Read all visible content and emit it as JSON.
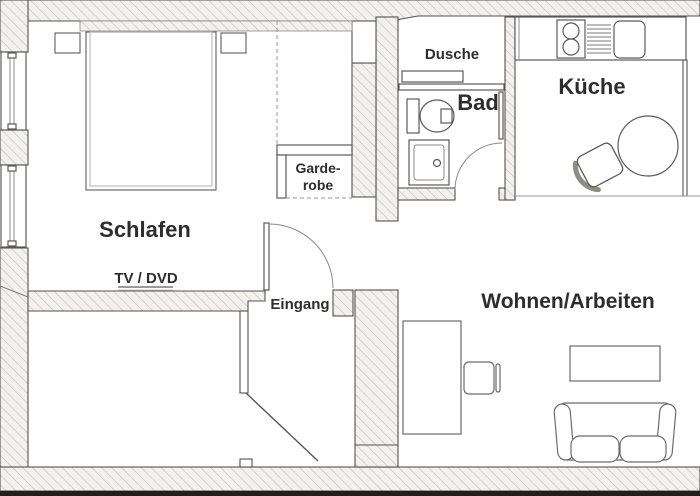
{
  "plan": {
    "type": "apartment-floorplan",
    "labels": {
      "schlafen": "Schlafen",
      "tv_dvd": "TV / DVD",
      "eingang": "Eingang",
      "garderobe_line1": "Garde-",
      "garderobe_line2": "robe",
      "dusche": "Dusche",
      "bad": "Bad",
      "kueche": "Küche",
      "wohnen_arbeiten": "Wohnen/Arbeiten"
    },
    "fixtures": [
      "double-bed",
      "nightstand-left",
      "nightstand-right",
      "wardrobe-shelf",
      "window-left-upper",
      "window-left-lower",
      "bedroom-door",
      "entrance-door",
      "tv-dvd-shelf",
      "shower-shelf",
      "shower-screen",
      "toilet",
      "washbasin",
      "bathroom-door",
      "stove-two-burners",
      "drainer",
      "kitchen-sink",
      "kitchen-counter",
      "dining-table-round",
      "dining-chair",
      "desk",
      "desk-chair",
      "coffee-table",
      "sofa"
    ],
    "colors": {
      "background": "#ffffff",
      "wall_fill": "#f3f1ee",
      "wall_hatch": "#bdb9b2",
      "line": "#55524e",
      "furniture_line": "#6b6b6b",
      "text": "#2d2d2d",
      "bottom_border": "#1f1f1f"
    }
  }
}
